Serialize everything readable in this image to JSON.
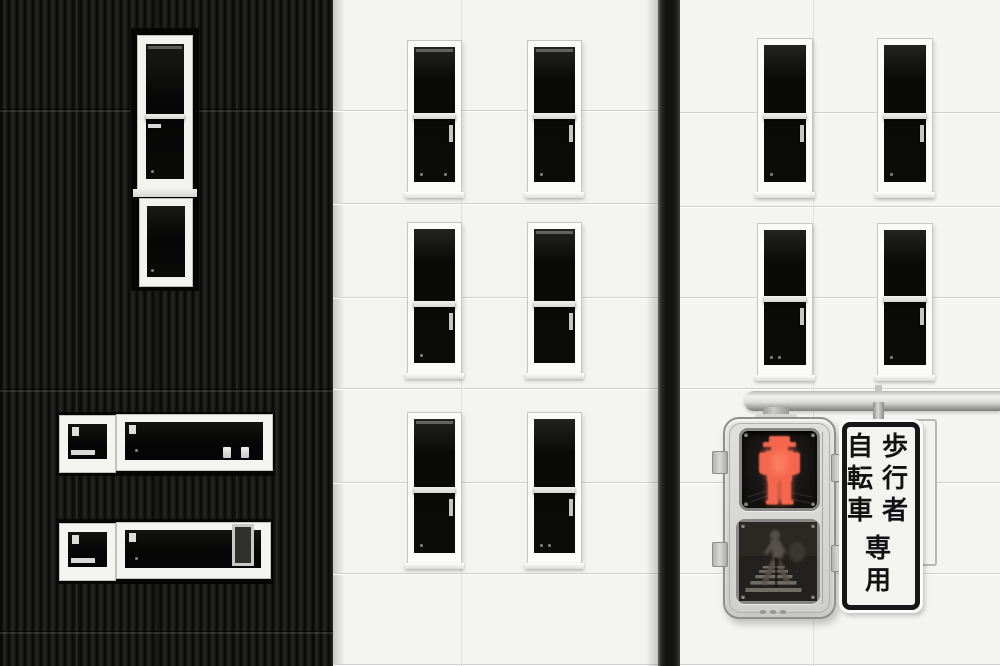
{
  "scene": {
    "description": "Monochrome street scene: black ribbed facade, white facades with narrow dark windows, Japanese pedestrian signal lit red, vertical regulatory sign",
    "signal_state": "stop"
  },
  "sign": {
    "column_right": [
      "歩",
      "行",
      "者"
    ],
    "column_left": [
      "自",
      "転",
      "車"
    ],
    "column_bottom": [
      "専",
      "用"
    ],
    "full_text": "歩行者自転車専用"
  },
  "signal": {
    "top_lens_icon": "red-standing-man-icon",
    "bottom_lens_icon": "walking-man-crosswalk-icon"
  },
  "colors": {
    "red_man": "#f4664e",
    "red_man_glow": "#ff8f73",
    "signal_body": "#d7d7d5",
    "dark_facade": "#141412",
    "light_facade": "#f3f3f1",
    "sign_border": "#171717"
  }
}
